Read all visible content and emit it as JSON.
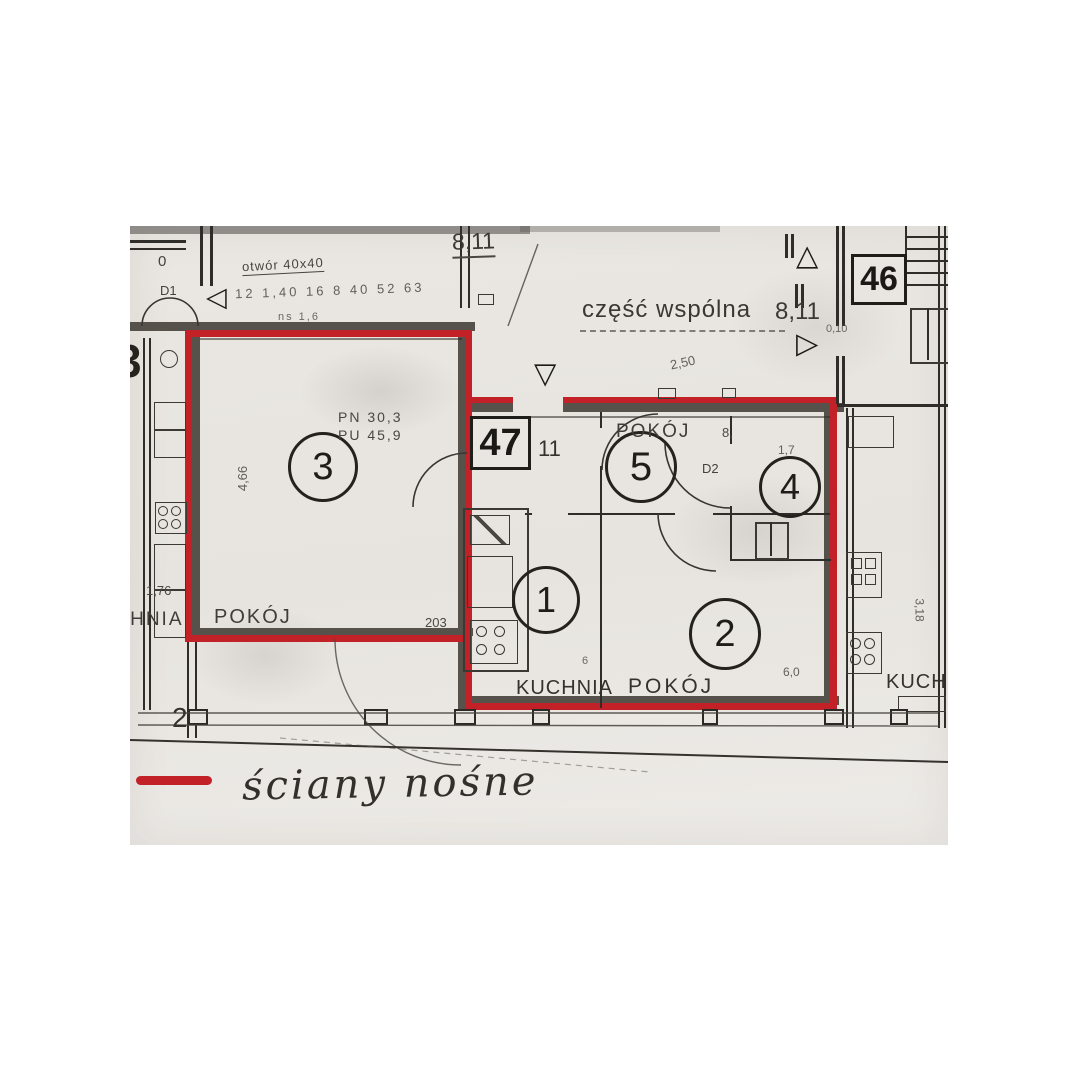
{
  "colors": {
    "red": "#c32128",
    "wall": "#56514b",
    "ink": "#26231f",
    "paper": "#e9e6e1"
  },
  "icons": {
    "tri_up": "△",
    "tri_down": "▽",
    "tri_left": "◁",
    "tri_right": "▷"
  },
  "units": {
    "current": "47",
    "neighbor": "46"
  },
  "corridor": {
    "label": "część wspólna",
    "area": "8,11",
    "opening_note": "otwór 40x40",
    "opening_area": "8,11",
    "dims_row": "12 1,40 16 8 40 52 63",
    "dims_small": "ns 1,6",
    "dim_diag": "2,50",
    "dim_wall": "0,10"
  },
  "hall": {
    "dim": "11"
  },
  "rooms": {
    "r1": {
      "num": "1",
      "label": "KUCHNIA",
      "dim": "6"
    },
    "r2": {
      "num": "2",
      "label": "POKÓJ",
      "dim": "6,0"
    },
    "r3": {
      "num": "3",
      "label": "POKÓJ",
      "stat_pn": "PN 30,3",
      "stat_pu": "PU 45,9",
      "dim_width": "4,66",
      "dim_door": "203"
    },
    "r4": {
      "num": "4",
      "dim": "1,7"
    },
    "r5": {
      "num": "5",
      "label": "POKÓJ",
      "dim": "8,"
    }
  },
  "doors": {
    "d1": "D1",
    "d2": "D2"
  },
  "neighbor_left": {
    "kitchen_label": "KUCHNIA",
    "dim": "1,76",
    "room_zero": "0",
    "partial_number": "3",
    "balcony_dim": "2"
  },
  "neighbor_right": {
    "kitchen_label": "KUCHNIA",
    "dim_height": "3,18"
  },
  "legend": {
    "text": "ściany nośne"
  }
}
